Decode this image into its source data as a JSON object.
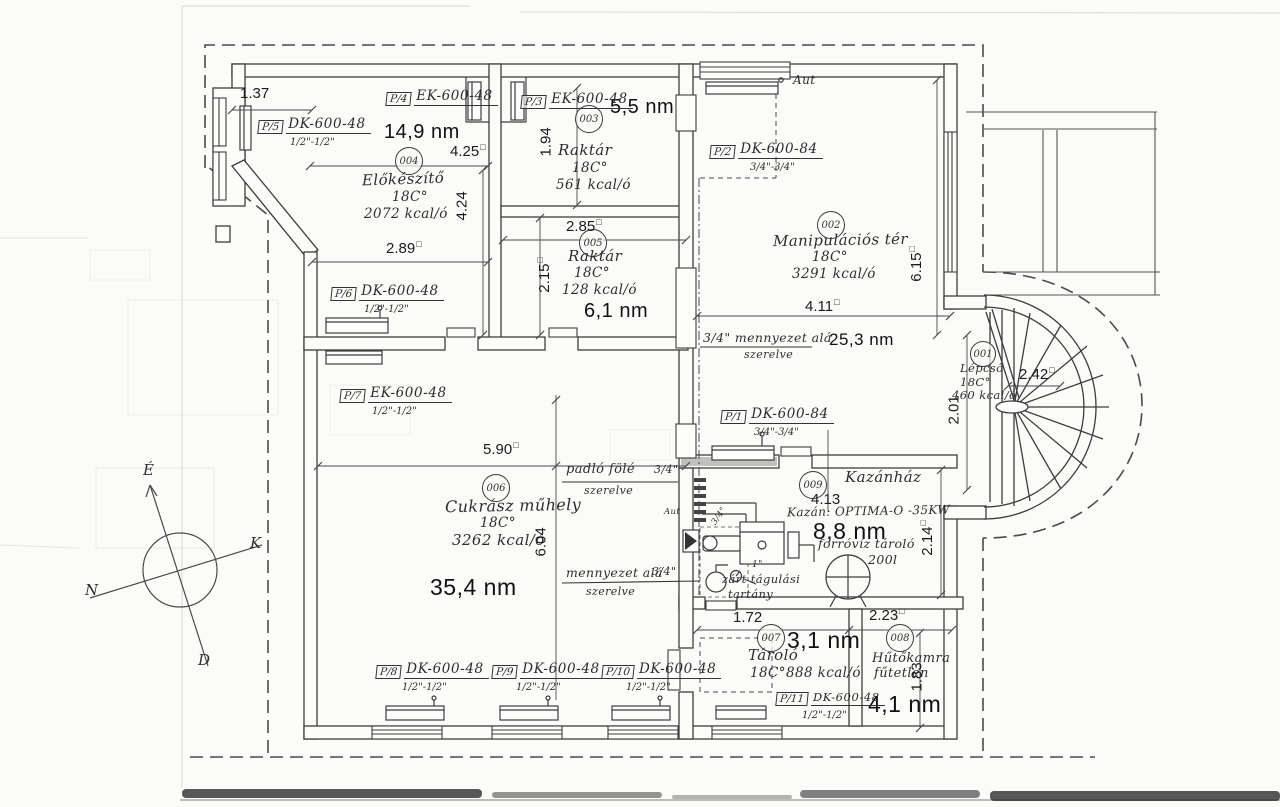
{
  "drawing": {
    "rooms": {
      "lepcso": {
        "num": "001",
        "name": "Lépcső",
        "temp": "18C°",
        "heat": "460 kcal/ó"
      },
      "manipulacios_ter": {
        "num": "002",
        "name": "Manipulációs tér",
        "temp": "18C°",
        "heat": "3291 kcal/ó",
        "area": "25,3 nm"
      },
      "raktar_felso": {
        "num": "003",
        "name": "Raktár",
        "temp": "18C°",
        "heat": "561 kcal/ó",
        "area": "5,5 nm"
      },
      "elokeszito": {
        "num": "004",
        "name": "Előkészítő",
        "temp": "18C°",
        "heat": "2072 kcal/ó",
        "area": "14,9 nm"
      },
      "raktar_also": {
        "num": "005",
        "name": "Raktár",
        "temp": "18C°",
        "heat": "128 kcal/ó",
        "area": "6,1 nm"
      },
      "cukrasz_muhely": {
        "num": "006",
        "name": "Cukrász műhely",
        "temp": "18C°",
        "heat": "3262 kcal/ó",
        "area": "35,4 nm"
      },
      "tarolo": {
        "num": "007",
        "name": "Tároló",
        "temp": "18C°",
        "heat": "888 kcal/ó",
        "area": "3,1 nm"
      },
      "hutokamra": {
        "num": "008",
        "name": "Hűtőkamra",
        "note": "fűtetlen",
        "area": "4,1 nm"
      },
      "kazanhaz": {
        "num": "009",
        "name": "Kazánház",
        "area": "8,8 nm"
      }
    },
    "radiators": {
      "p1": {
        "tag": "P/1",
        "model": "DK-600-84",
        "conn": "3/4\"-3/4\""
      },
      "p2": {
        "tag": "P/2",
        "model": "DK-600-84",
        "conn": "3/4\"-3/4\""
      },
      "p3": {
        "tag": "P/3",
        "model": "EK-600-48"
      },
      "p4": {
        "tag": "P/4",
        "model": "EK-600-48"
      },
      "p5": {
        "tag": "P/5",
        "model": "DK-600-48",
        "conn": "1/2\"-1/2\""
      },
      "p6": {
        "tag": "P/6",
        "model": "DK-600-48",
        "conn": "1/2\"-1/2\""
      },
      "p7": {
        "tag": "P/7",
        "model": "EK-600-48",
        "conn": "1/2\"-1/2\""
      },
      "p8": {
        "tag": "P/8",
        "model": "DK-600-48",
        "conn": "1/2\"-1/2\""
      },
      "p9": {
        "tag": "P/9",
        "model": "DK-600-48",
        "conn": "1/2\"-1/2\""
      },
      "p10": {
        "tag": "P/10",
        "model": "DK-600-48",
        "conn": "1/2\"-1/2\""
      },
      "p11": {
        "tag": "P/11",
        "model": "DK-600-48",
        "conn": "1/2\"-1/2\""
      }
    },
    "dimensions": {
      "d1_37": "1.37",
      "d4_25": "4.25",
      "d2_89": "2.89",
      "d1_94": "1.94",
      "d4_24": "4.24",
      "d2_85": "2.85",
      "d2_15": "2.15",
      "d6_15": "6.15",
      "d4_11": "4.11",
      "d2_01": "2.01",
      "d2_42": "2.42",
      "d5_90": "5.90",
      "d6_04": "6.04",
      "d4_13": "4.13",
      "d2_14": "2.14",
      "d1_72": "1.72",
      "d2_23": "2.23",
      "d1_83": "1.83"
    },
    "notes": {
      "ceiling_top_l1": "3/4\" mennyezet alá",
      "ceiling_top_l2": "szerelve",
      "floor_l1": "padló fölé",
      "floor_size": "3/4\"",
      "floor_l2": "szerelve",
      "ceiling_boiler_l1": "mennyezet alá",
      "ceiling_boiler_size": "3/4\"",
      "ceiling_boiler_l2": "szerelve",
      "aut": "Aut"
    },
    "boiler_room": {
      "boiler": "Kazán: OPTIMA-O -35KW",
      "tank_label": "forróvíz tároló",
      "tank_volume": "200l",
      "expansion_l1": "zárt tágulási",
      "expansion_l2": "tartány",
      "pipe_34": "3/4\"",
      "pipe_1": "1\""
    },
    "compass": {
      "north": "É",
      "east": "K",
      "west": "N",
      "south": "D"
    },
    "symbols": {
      "sq": "□"
    }
  }
}
